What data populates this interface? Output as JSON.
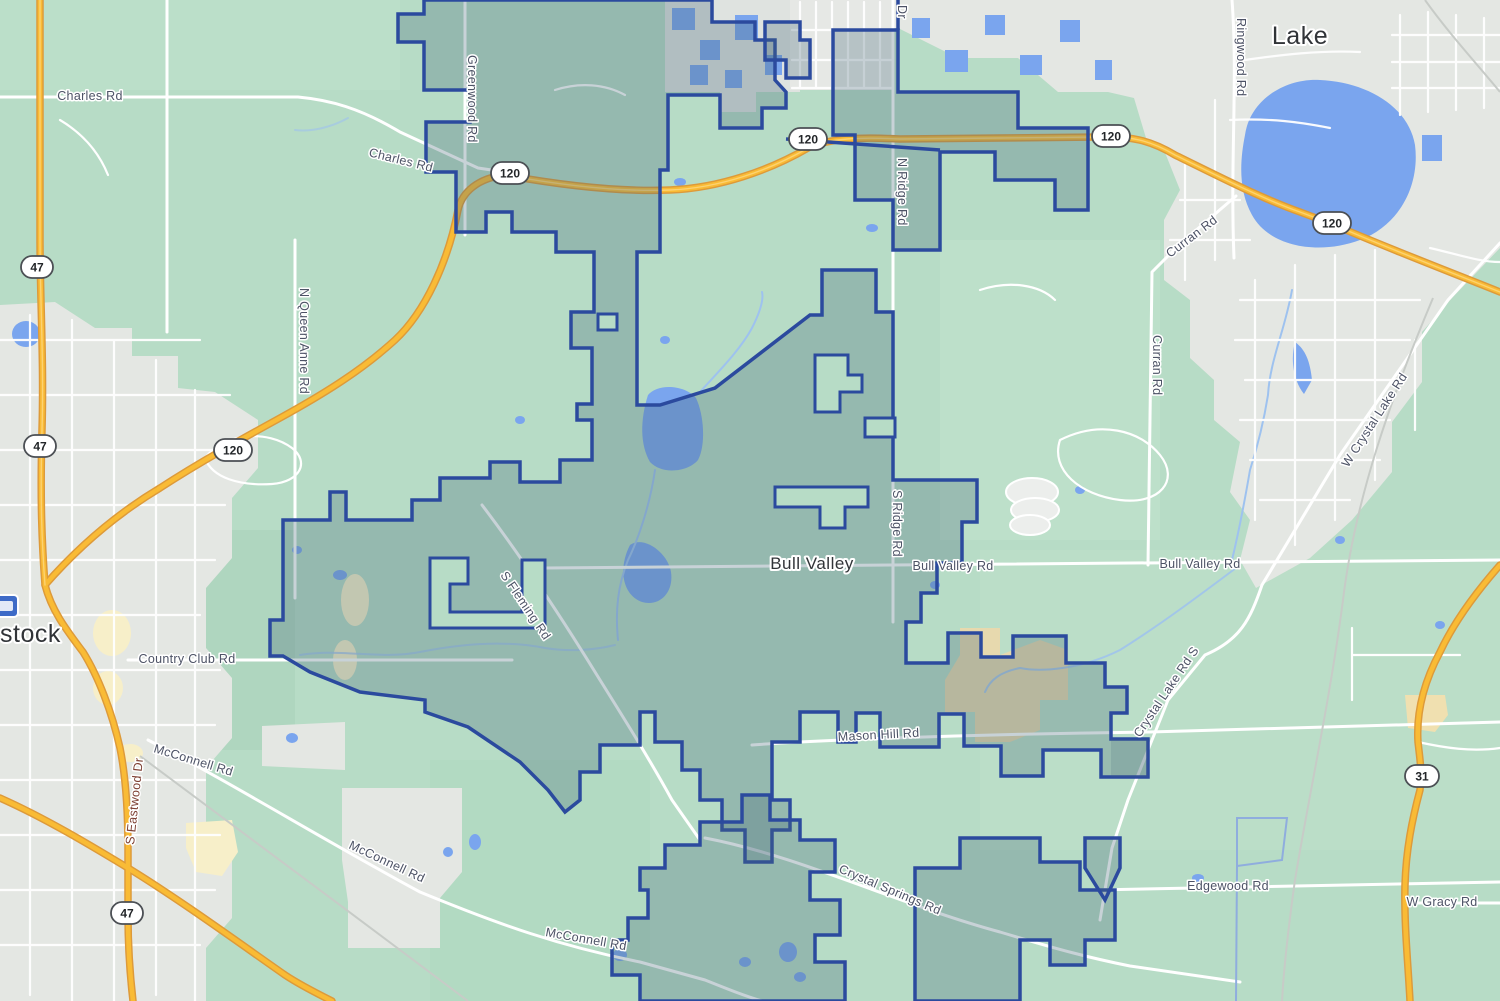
{
  "map": {
    "labels": {
      "towns": {
        "bull_valley": "Bull Valley",
        "woodstock_partial": "stock",
        "lake_partial": "Lake",
        "dr_partial": "Dr"
      },
      "roads": {
        "charles": "Charles Rd",
        "greenwood": "Greenwood Rd",
        "queen_anne": "N Queen Anne Rd",
        "n_ridge": "N Ridge Rd",
        "s_ridge": "S Ridge Rd",
        "ringwood": "Ringwood Rd",
        "curran": "Curran Rd",
        "w_crystal_lake": "W Crystal Lake Rd",
        "crystal_lake_s": "Crystal Lake Rd S",
        "bull_valley_rd": "Bull Valley Rd",
        "country_club": "Country Club Rd",
        "mcconnell": "McConnell Rd",
        "mason_hill": "Mason Hill Rd",
        "crystal_springs": "Crystal Springs Rd",
        "edgewood": "Edgewood Rd",
        "w_gracy": "W Gracy Rd",
        "s_fleming": "S Fleming Rd",
        "s_eastwood": "S Eastwood Dr"
      },
      "shields": {
        "r47": "47",
        "r120": "120",
        "r31": "31"
      }
    },
    "colors": {
      "land_color": "#b7dcc6",
      "urban_color": "#e4e7e3",
      "water_color": "#7aa5ee",
      "highway_color": "#f9bb35",
      "boundary_color": "#2b4a9e",
      "boundary_fill_color": "#4a6a7a",
      "golf_color": "#e7d9ae"
    }
  }
}
